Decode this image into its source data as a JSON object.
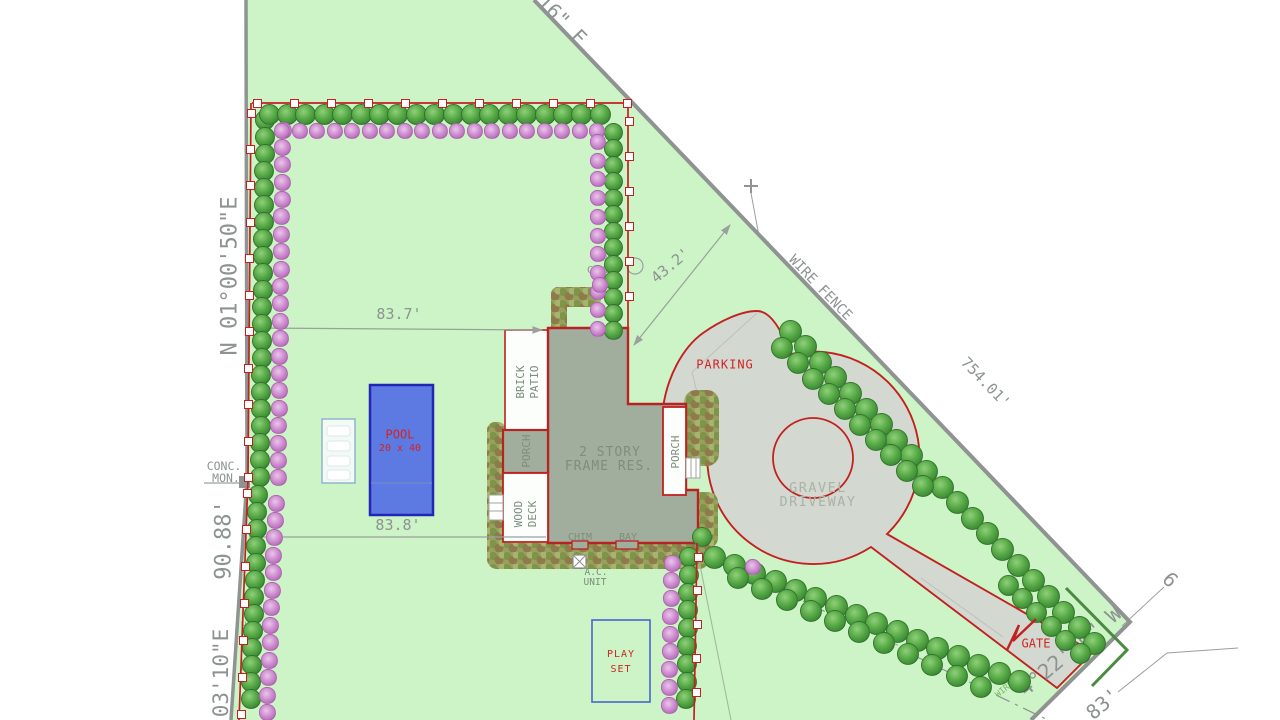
{
  "bearings": {
    "top_right": "16\" E",
    "west_upper": "N 01°00'50\"E",
    "west_lower": "03'10\"E",
    "south_right": "4°22'20\" W"
  },
  "distances": {
    "west_mid": "90.88'",
    "northeast_fence": "754.01'",
    "north_to_house": "83.7'",
    "south_to_house": "83.8'",
    "house_to_fence": "43.2'",
    "south_right": "83'",
    "offsite_partial": "6"
  },
  "labels": {
    "wire_fence_ne": "WIRE FENCE",
    "wire_fence_w": "WIRE FENCE",
    "wire_fence_se": "WIRE",
    "conc_mon_line1": "CONC.",
    "conc_mon_line2": "MON.",
    "ohd_util": "OHD. UTIL.",
    "grnd_cover_line1": "GRND",
    "grnd_cover_line2": "COVER"
  },
  "features": {
    "house_line1": "2 STORY",
    "house_line2": "FRAME RES.",
    "brick_patio_line1": "BRICK",
    "brick_patio_line2": "PATIO",
    "porch_left": "PORCH",
    "porch_right": "PORCH",
    "wood_deck_line1": "WOOD",
    "wood_deck_line2": "DECK",
    "chimney": "CHIM",
    "bay": "BAY",
    "ac_unit_line1": "A.C.",
    "ac_unit_line2": "UNIT",
    "pool_line1": "POOL",
    "pool_line2": "20 x 40",
    "play_set_line1": "PLAY",
    "play_set_line2": "SET",
    "parking": "PARKING",
    "gravel_line1": "GRAVEL",
    "gravel_line2": "DRIVEWAY",
    "gate": "GATE"
  },
  "colors": {
    "lawn": "#cdf4c6",
    "fence_red": "#c22121",
    "label_red": "#d12424",
    "pool_blue": "#5d7ae2",
    "pool_border": "#2126b6",
    "driveway_gray": "#d3d8d0",
    "house_gray": "#a2ae9d",
    "survey_text_gray": "#8d9392",
    "boundary_gray": "#8f9492",
    "tree_green": "#57a946",
    "bush_pink": "#cb87cd",
    "wire_fence_green": "#7fb269"
  }
}
